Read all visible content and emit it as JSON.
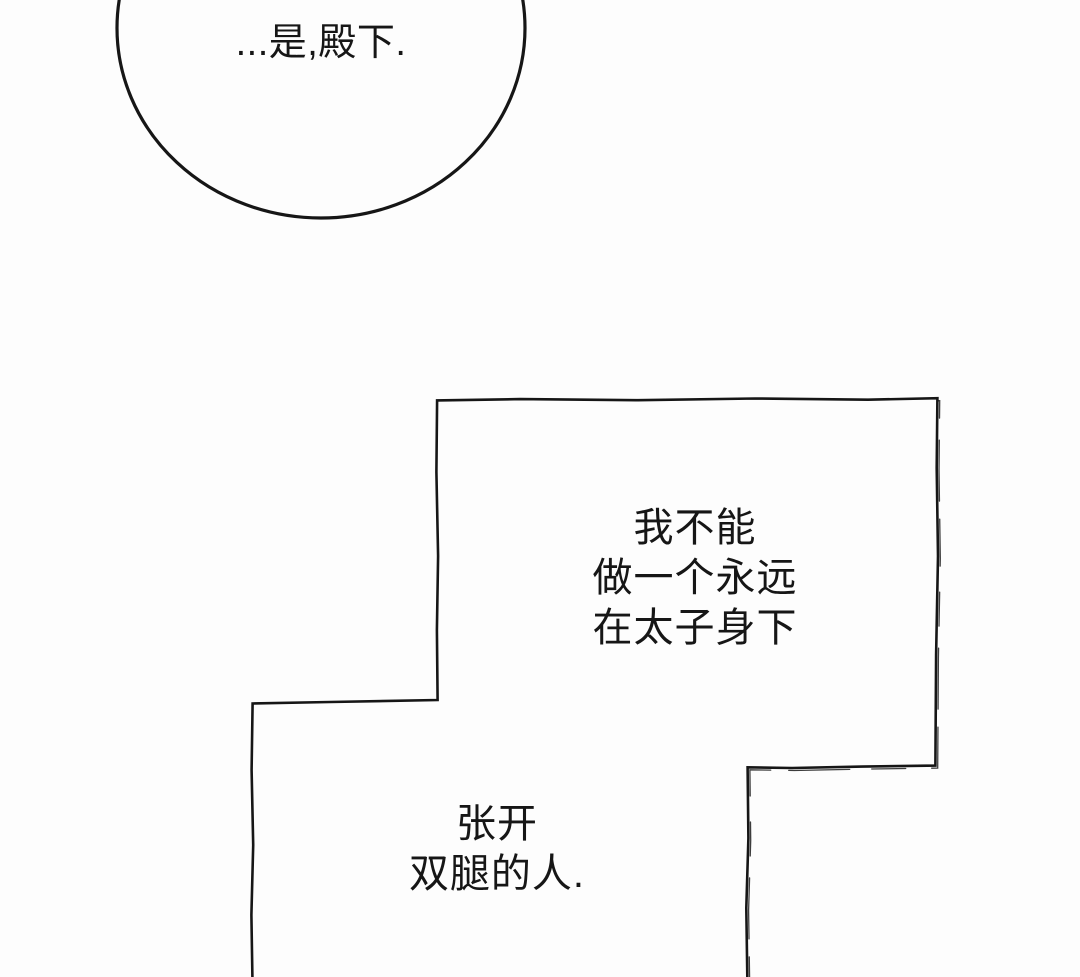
{
  "colors": {
    "ink": "#161616",
    "ink_soft": "#3d3d3d",
    "paper": "#fdfdfd"
  },
  "speech_bubble": {
    "text": "...是,殿下."
  },
  "narration_upper": {
    "lines": [
      "我不能",
      "做一个永远",
      "在太子身下"
    ]
  },
  "narration_lower": {
    "lines": [
      "张开",
      "双腿的人."
    ]
  }
}
